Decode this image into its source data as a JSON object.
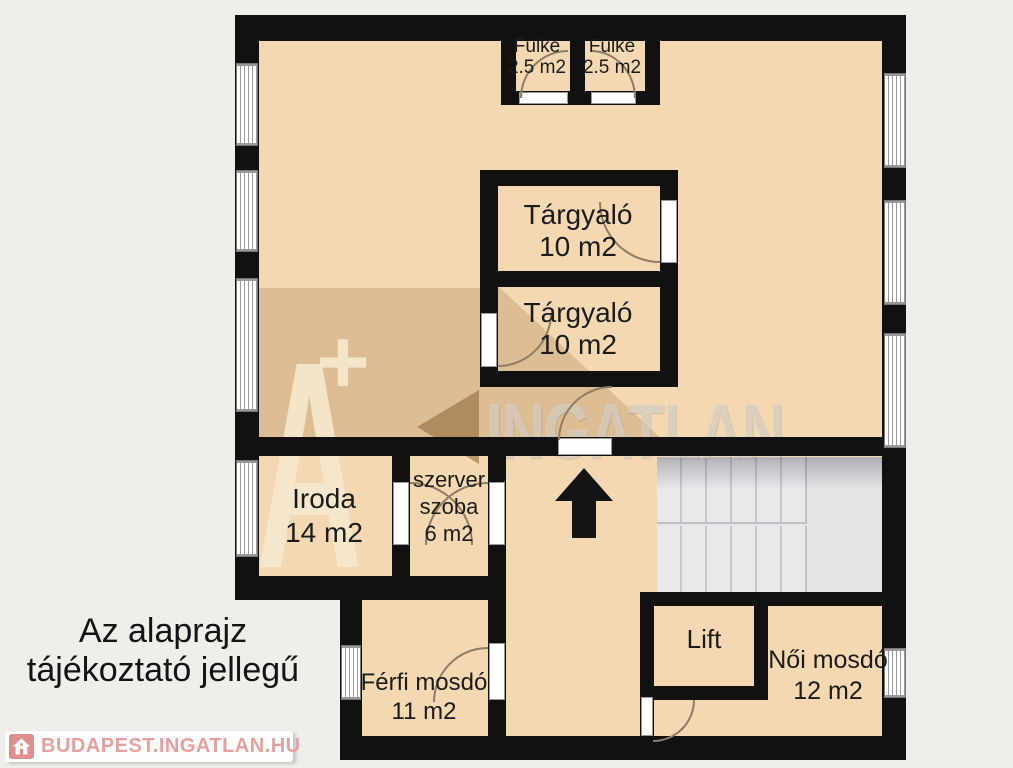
{
  "rooms": {
    "fulke1": {
      "name": "Fülke",
      "area": "2.5 m2"
    },
    "fulke2": {
      "name": "Fülke",
      "area": "2.5 m2"
    },
    "targyalo1": {
      "name": "Tárgyaló",
      "area": "10 m2"
    },
    "targyalo2": {
      "name": "Tárgyaló",
      "area": "10 m2"
    },
    "iroda": {
      "name": "Iroda",
      "area": "14 m2"
    },
    "szerver": {
      "line1": "szerver",
      "line2": "szoba",
      "area": "6 m2"
    },
    "lift": {
      "name": "Lift"
    },
    "ferfi": {
      "name": "Férfi mosdó",
      "area": "11 m2"
    },
    "noi": {
      "name": "Női mosdó",
      "area": "12 m2"
    }
  },
  "watermark": {
    "letter": "A",
    "plus": "+",
    "brand": "INGATLAN"
  },
  "disclaimer": {
    "line1": "Az alaprajz",
    "line2": "tájékoztató jellegű"
  },
  "footer": {
    "brand": "BUDAPEST.INGATLAN.HU"
  },
  "colors": {
    "floor": "#f4d8b1",
    "wall": "#111111",
    "background": "#efeeea",
    "stairs": "#e4e4e7",
    "logo_text": "#e5a0a0"
  }
}
